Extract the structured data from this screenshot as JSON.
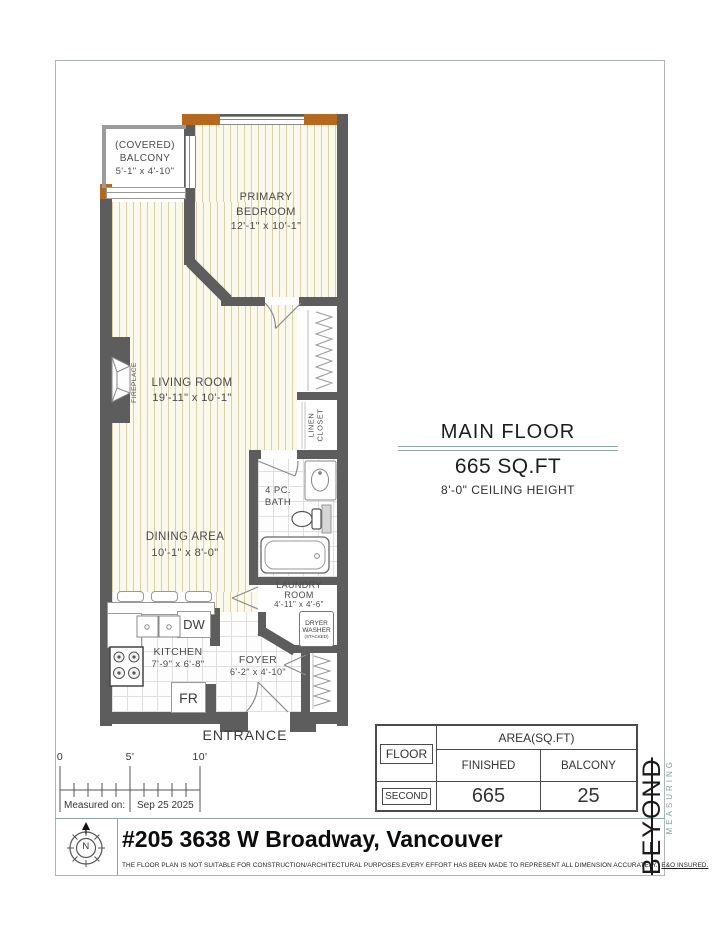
{
  "plan": {
    "rooms": {
      "balcony": {
        "line1": "(COVERED)",
        "line2": "BALCONY",
        "dims": "5'-1\" x 4'-10\""
      },
      "primary_bedroom": {
        "line1": "PRIMARY",
        "line2": "BEDROOM",
        "dims": "12'-1\" x 10'-1\""
      },
      "living_room": {
        "name": "LIVING ROOM",
        "dims": "19'-11\" x 10'-1\""
      },
      "dining_area": {
        "name": "DINING AREA",
        "dims": "10'-1\" x 8'-0\""
      },
      "kitchen": {
        "name": "KITCHEN",
        "dims": "7'-9\" x 6'-8\""
      },
      "foyer": {
        "name": "FOYER",
        "dims": "6'-2\" x 4'-10\""
      },
      "bath": {
        "line1": "4 PC.",
        "line2": "BATH"
      },
      "laundry_room": {
        "line1": "LAUNDRY",
        "line2": "ROOM",
        "dims": "4'-11\" x 4'-6\""
      },
      "linen_closet": {
        "line1": "LINEN",
        "line2": "CLOSET"
      },
      "fireplace": "FIREPLACE",
      "entrance": "ENTRANCE"
    },
    "appliances": {
      "dishwasher": "DW",
      "fridge": "FR",
      "dryer": "DRYER",
      "washer": "WASHER",
      "stacked": "(STACKED)"
    }
  },
  "floor_info": {
    "title": "MAIN FLOOR",
    "area": "665 SQ.FT",
    "ceiling": "8'-0\" CEILING HEIGHT"
  },
  "scale_bar": {
    "tick0": "0",
    "tick5": "5'",
    "tick10": "10'",
    "measured_label": "Measured on:",
    "measured_date": "Sep 25 2025"
  },
  "area_table": {
    "floor_header": "FLOOR",
    "area_header": "AREA(SQ.FT)",
    "finished_header": "FINISHED",
    "balcony_header": "BALCONY",
    "floor_value": "SECOND",
    "finished_value": "665",
    "balcony_value": "25"
  },
  "footer": {
    "title": "#205 3638 W Broadway, Vancouver",
    "disclaimer": "THE FLOOR PLAN IS NOT SUITABLE FOR CONSTRUCTION/ARCHITECTURAL PURPOSES.EVERY EFFORT HAS BEEN MADE TO REPRESENT ALL DIMENSION ACCURATELY.",
    "disclaimer_link": "E&O INSURED.",
    "compass_letter": "N"
  },
  "logo": {
    "line1": "BEYOND",
    "line2": "MEASURING"
  },
  "colors": {
    "wall": "#5d5d5d",
    "wood_accent": "#b5691f",
    "floor_stripe": "#d9d0a8",
    "logo_accent": "#7ba3a3",
    "rule": "#8fa6a6"
  }
}
